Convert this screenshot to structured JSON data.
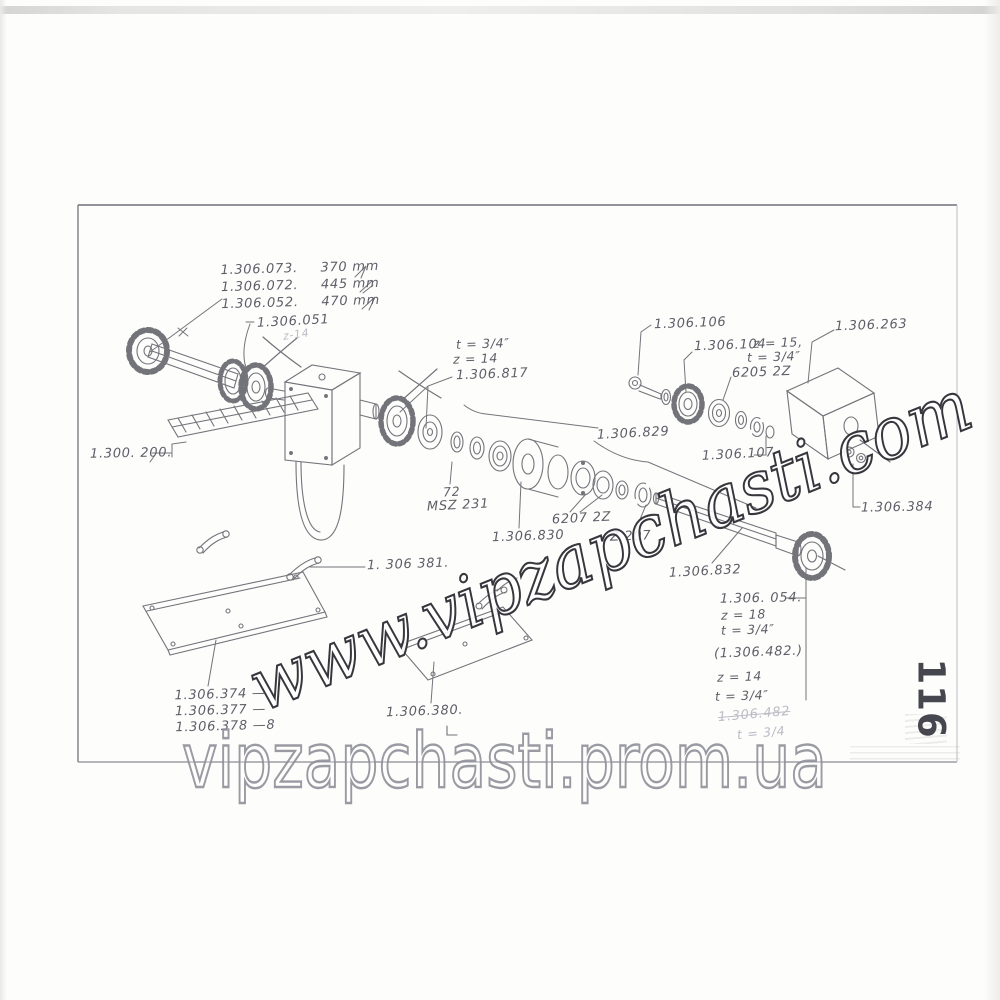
{
  "page": {
    "number": "116"
  },
  "watermarks": {
    "diagonal": "www.vipzapchasti.com",
    "bottom": "vipzapchasti.prom.ua"
  },
  "colors": {
    "ink": "#5c5c64",
    "label_text": "#5e5e68",
    "diagonal_outline": "#36363c",
    "bottom_outline": "#90909a",
    "page_number": "#46464e"
  },
  "labels": {
    "shaft_variants": {
      "rows": [
        {
          "part": "1.306.073.",
          "length": "370 mm"
        },
        {
          "part": "1.306.072.",
          "length": "445 mm"
        },
        {
          "part": "1.306.052.",
          "length": "470 mm"
        }
      ]
    },
    "p051": "1.306.051",
    "pencil_note": "z-14",
    "sp817": {
      "t": "t = 3/4″",
      "z": "z = 14",
      "part": "1.306.817"
    },
    "p200": "1.300. 200.",
    "gearbox": {
      "qty": "72",
      "type": "MSZ 231"
    },
    "p830": "1.306.830",
    "b6207": "6207 2Z",
    "z207": "Z 207",
    "p829": "1.306.829",
    "p106": "1.306.106",
    "sp104": {
      "part": "1.306.104",
      "z": "z = 15,",
      "t": "t = 3/4″"
    },
    "b6205": "6205 2Z",
    "p263": "1.306.263",
    "p107": "1.306.107",
    "p384": "1.306.384",
    "p832": "1.306.832",
    "sp054": {
      "part": "1.306. 054.",
      "z": "z = 18",
      "t": "t = 3/4″"
    },
    "alt482": {
      "part": "(1.306.482.)",
      "z": "z = 14",
      "t": "t = 3/4″"
    },
    "hand482": {
      "part": "1.306.482",
      "t": "t = 3/4"
    },
    "p381": "1. 306 381.",
    "plate_variants": {
      "rows": [
        "1.306.374 —",
        "1.306.377 —",
        "1.306.378 —8"
      ]
    },
    "p380": "1.306.380."
  }
}
